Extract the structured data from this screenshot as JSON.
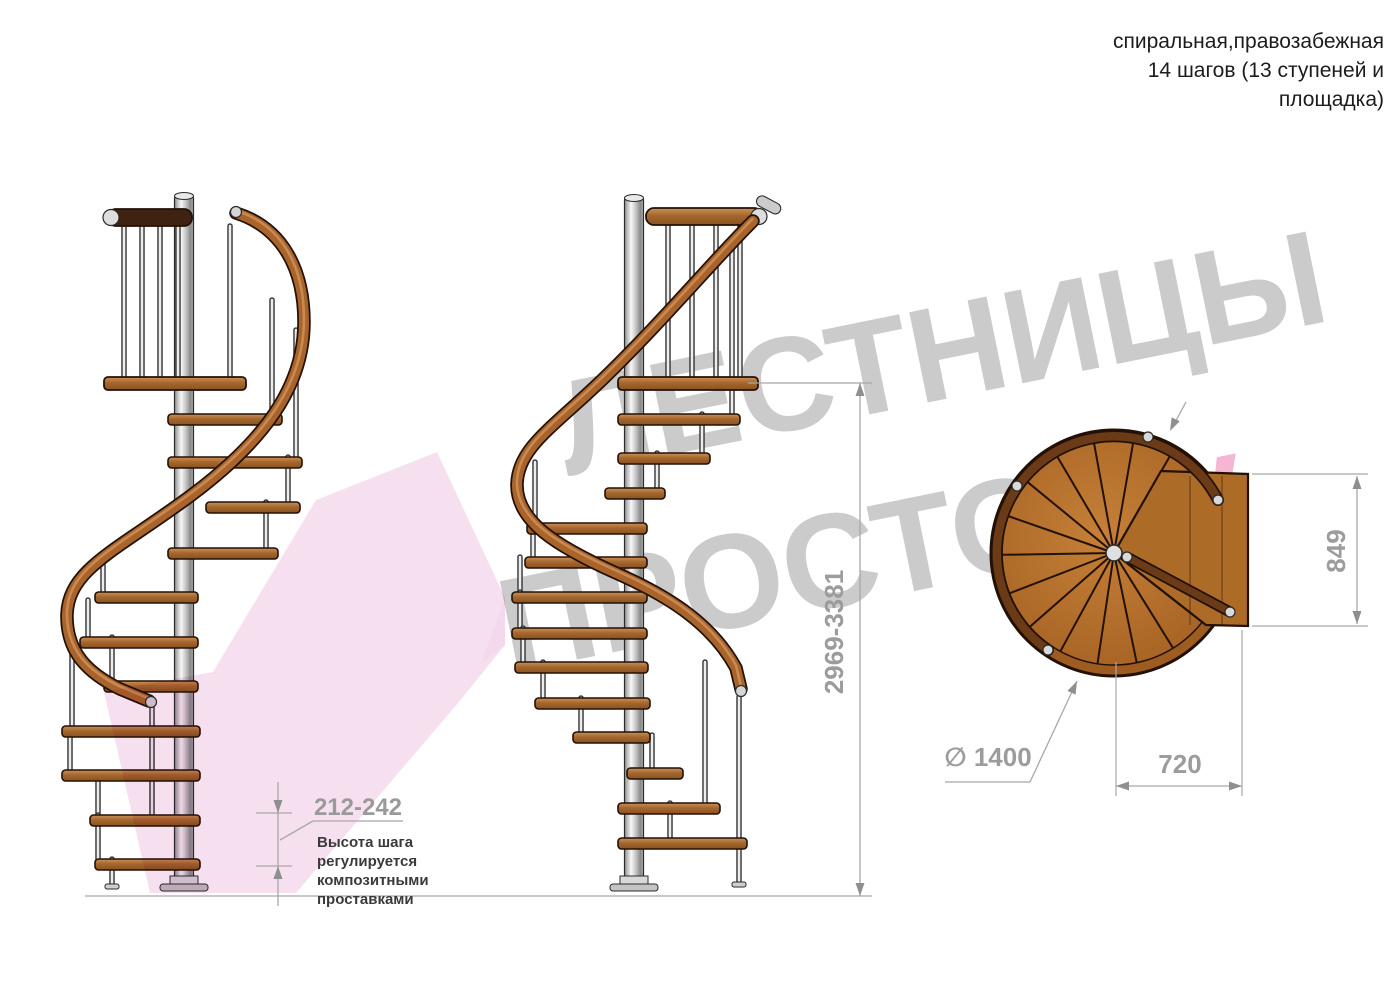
{
  "header": {
    "line1": "спиральная,правозабежная",
    "line2": "14 шагов (13 ступеней и",
    "line3": "площадка)"
  },
  "watermark": {
    "line1": "ЛЕСТНИЦЫ",
    "line2_gray": "ПРОСТО",
    "line2_pink": ".ру"
  },
  "dimensions": {
    "total_height": "2969-3381",
    "platform_depth": "849",
    "step_width": "720",
    "diameter": "∅ 1400",
    "step_height": "212-242",
    "step_height_note_lines": [
      "Высота шага",
      "регулируется",
      "композитными",
      "проставками"
    ]
  },
  "colors": {
    "outline": "#2b2b2b",
    "wood_outline": "#231106",
    "rail_brown": "#a9642c",
    "rail_highlight": "#d0945c",
    "rail_dark": "#3f2312",
    "plan_rail": "#6b3a16",
    "metal_light": "#ededed",
    "metal_dark": "#3a3a3a",
    "dim_line": "#a8a8a8",
    "dim_arrow": "#8f8f8f",
    "dim_text": "#9c9c9c",
    "note_text": "#3a3a3a",
    "header_text": "#1c1c1c",
    "watermark_gray": "#cbcbcb",
    "watermark_pink": "#f4b6d2",
    "arrow_pink": "#eec2e2"
  },
  "geometry": {
    "side_views": [
      {
        "name": "side-view-left",
        "pole_x": 184,
        "pole_top": 196,
        "pole_bottom": 884,
        "platform_rail": {
          "x1": 108,
          "x2": 192,
          "y": 209,
          "h": 17,
          "dark": true,
          "cap_end": "left"
        },
        "platform_board": {
          "x1": 104,
          "x2": 246,
          "y": 377
        },
        "platform_balusters": [
          124,
          142,
          160,
          178,
          230
        ],
        "rail_path": "M 236 213 C 283 228 304 270 304 322 C 304 388 262 442 193 494 C 118 550 69 568 67 614 C 66 654 90 674 120 689 L 149 701",
        "rail_caps": [
          [
            236,
            212
          ],
          [
            151,
            702
          ]
        ],
        "steps": [
          [
            414,
            168,
            282
          ],
          [
            457,
            168,
            302
          ],
          [
            502,
            206,
            300
          ],
          [
            548,
            168,
            278
          ],
          [
            592,
            95,
            198
          ],
          [
            637,
            80,
            198
          ],
          [
            681,
            104,
            198
          ],
          [
            726,
            62,
            200
          ],
          [
            770,
            62,
            200
          ],
          [
            815,
            90,
            200
          ],
          [
            859,
            95,
            200
          ]
        ],
        "balusters": [
          [
            272,
            300,
            414
          ],
          [
            296,
            330,
            457
          ],
          [
            288,
            457,
            502
          ],
          [
            266,
            502,
            548
          ],
          [
            103,
            565,
            592
          ],
          [
            88,
            600,
            637
          ],
          [
            112,
            637,
            681
          ],
          [
            72,
            637,
            726
          ],
          [
            70,
            728,
            770
          ],
          [
            98,
            772,
            815
          ],
          [
            98,
            815,
            859
          ],
          [
            112,
            859,
            884
          ],
          [
            152,
            706,
            815
          ]
        ],
        "feet": [
          [
            112,
            884
          ]
        ]
      },
      {
        "name": "side-view-center",
        "pole_x": 634,
        "pole_top": 198,
        "pole_bottom": 884,
        "platform_rail": {
          "x1": 646,
          "x2": 762,
          "y": 208,
          "h": 17,
          "dark": false,
          "cap_end": "right"
        },
        "platform_board": {
          "x1": 618,
          "x2": 758,
          "y": 377
        },
        "platform_balusters": [
          668,
          692,
          716,
          740
        ],
        "rail_path": "M 753 221 C 712 262 662 322 602 380 C 552 428 518 448 517 484 C 516 521 556 546 616 573 C 673 598 713 626 736 668 L 741 689",
        "rail_caps": [
          [
            741,
            691
          ]
        ],
        "steps": [
          [
            414,
            618,
            740
          ],
          [
            453,
            618,
            710
          ],
          [
            488,
            605,
            665
          ],
          [
            523,
            527,
            647
          ],
          [
            557,
            525,
            647
          ],
          [
            592,
            512,
            647
          ],
          [
            628,
            512,
            647
          ],
          [
            662,
            515,
            648
          ],
          [
            698,
            535,
            650
          ],
          [
            732,
            573,
            650
          ],
          [
            768,
            627,
            683
          ],
          [
            803,
            618,
            720
          ],
          [
            838,
            618,
            747
          ]
        ],
        "balusters": [
          [
            732,
            250,
            414
          ],
          [
            702,
            414,
            453
          ],
          [
            657,
            453,
            488
          ],
          [
            535,
            462,
            523
          ],
          [
            533,
            523,
            557
          ],
          [
            520,
            557,
            592
          ],
          [
            520,
            592,
            628
          ],
          [
            523,
            628,
            662
          ],
          [
            543,
            662,
            698
          ],
          [
            581,
            698,
            732
          ],
          [
            652,
            735,
            768
          ],
          [
            705,
            662,
            803
          ],
          [
            670,
            803,
            838
          ],
          [
            739,
            697,
            882
          ]
        ],
        "feet": [
          [
            739,
            882
          ]
        ]
      }
    ],
    "plan": {
      "cx": 1114,
      "cy": 553,
      "r_outer": 123,
      "r_inner": 112,
      "r_rail": 117,
      "sector_start_deg": 38,
      "sector_span_deg": 262,
      "sectors": 13,
      "platform": "1114,553 1161,471 1248,474 1248,626 1206,625",
      "plank_lines": [
        [
          1190,
          476,
          625
        ],
        [
          1222,
          476,
          625
        ]
      ],
      "rail_arc": "M 1048 650 A 117 117 0 1 1 1218 500",
      "straight_rail": [
        1127,
        557,
        1230,
        612
      ],
      "dots": [
        [
          1048,
          650
        ],
        [
          1218,
          500
        ],
        [
          1127,
          557
        ],
        [
          1230,
          612
        ],
        [
          1148,
          437
        ],
        [
          1017,
          486
        ]
      ],
      "pole_r": 8
    },
    "arrow_polys": [
      {
        "points": "316,500 437,452 505,598 480,665 213,672",
        "op": 0.5
      },
      {
        "points": "480,665 505,598 505,645",
        "op": 0.62
      },
      {
        "points": "213,672 480,665 505,645 458,703 296,893 150,893 104,692",
        "op": 0.5
      }
    ],
    "dims": {
      "total": {
        "vline": [
          860,
          383,
          896
        ],
        "ext": [
          [
            748,
            383,
            872,
            383
          ],
          [
            85,
            896,
            872,
            896
          ]
        ],
        "arrows": [
          [
            860,
            383,
            "up"
          ],
          [
            860,
            896,
            "down"
          ]
        ]
      },
      "d849": {
        "vline": [
          1357,
          476,
          624
        ],
        "ext": [
          [
            1252,
            474,
            1368,
            474
          ],
          [
            1252,
            626,
            1368,
            626
          ]
        ],
        "arrows": [
          [
            1357,
            476,
            "up"
          ],
          [
            1357,
            624,
            "down"
          ]
        ]
      },
      "d720": {
        "hline": [
          1116,
          786,
          1242
        ],
        "ext": [
          [
            1116,
            662,
            1116,
            796
          ],
          [
            1242,
            630,
            1242,
            796
          ]
        ],
        "arrows": [
          [
            1116,
            786,
            "left"
          ],
          [
            1242,
            786,
            "right"
          ]
        ]
      },
      "dia": {
        "underline": [
          945,
          782,
          1030,
          782
        ],
        "leader": [
          1030,
          782,
          1077,
          681
        ],
        "arrow_rot": 25
      },
      "top_arrow": {
        "line": [
          1186,
          402,
          1172,
          428
        ],
        "arrow_rot": 26
      },
      "step_h": {
        "vline": [
          278,
          782,
          906
        ],
        "ticks": [
          [
            256,
            813,
            292,
            813
          ],
          [
            256,
            866,
            292,
            866
          ]
        ],
        "arrows": [
          [
            278,
            813,
            "down"
          ],
          [
            278,
            866,
            "up"
          ]
        ],
        "underline": [
          313,
          821,
          403,
          821
        ],
        "leader": [
          313,
          821,
          280,
          840
        ]
      }
    }
  }
}
